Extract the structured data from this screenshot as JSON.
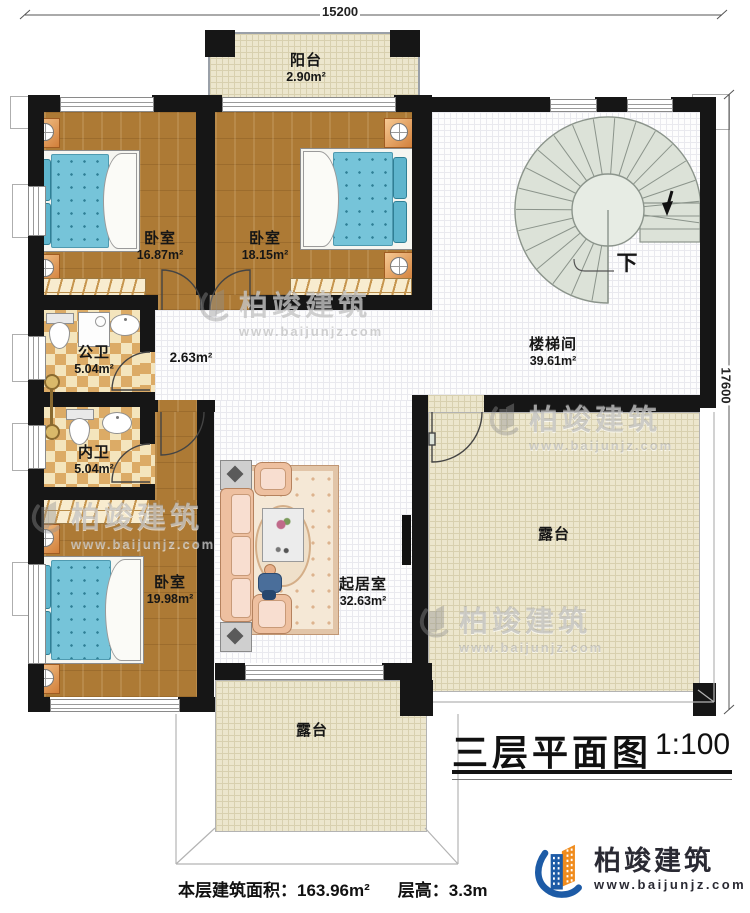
{
  "plan": {
    "dims": {
      "width_label": "15200",
      "height_label": "17600"
    },
    "rooms": {
      "balcony": {
        "name": "阳台",
        "area": "2.90m²"
      },
      "bedroom_top_left": {
        "name": "卧室",
        "area": "16.87m²"
      },
      "bedroom_top_mid": {
        "name": "卧室",
        "area": "18.15m²"
      },
      "bedroom_bottom": {
        "name": "卧室",
        "area": "19.98m²"
      },
      "public_bath": {
        "name": "公卫",
        "area": "5.04m²"
      },
      "private_bath": {
        "name": "内卫",
        "area": "5.04m²"
      },
      "hallway": {
        "area": "2.63m²"
      },
      "stairwell": {
        "name": "楼梯间",
        "area": "39.61m²"
      },
      "living_room": {
        "name": "起居室",
        "area": "32.63m²"
      },
      "terrace_right": {
        "name": "露台"
      },
      "terrace_bottom": {
        "name": "露台"
      }
    },
    "stair_down_label": "下"
  },
  "titleblock": {
    "title": "三层平面图",
    "scale": "1:100"
  },
  "footer": {
    "area_label": "本层建筑面积：",
    "area_value": "163.96m²",
    "height_label": "层高：",
    "height_value": "3.3m"
  },
  "brand": {
    "name": "柏竣建筑",
    "url": "www.baijunjz.com"
  },
  "watermark": {
    "name": "柏竣建筑",
    "url": "www.baijunjz.com"
  },
  "colors": {
    "wall": "#161616",
    "wood": "#ad7a35",
    "terrace": "#ece6cd",
    "stair_fill": "#dce2d8",
    "bed_blue": "#76c4d9",
    "logo_blue": "#1d5ba6",
    "logo_orange": "#f08c1e"
  }
}
